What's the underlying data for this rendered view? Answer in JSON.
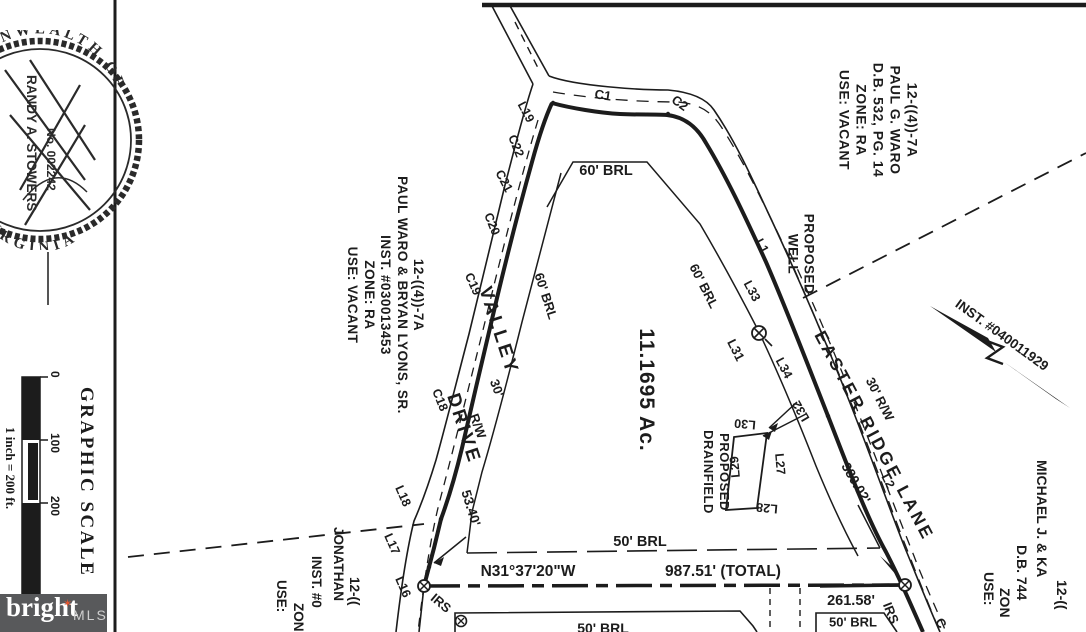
{
  "page": {
    "ink": "#1c1c1c",
    "paper": "#ffffff"
  },
  "seal": {
    "arc_top": "COMMONWEALTH OF",
    "arc_bottom": "VIRGINIA",
    "name": "RANDY A. STOWERS",
    "number": "No. 002242"
  },
  "scalebar": {
    "title": "GRAPHIC SCALE",
    "ticks": {
      "t0": "0",
      "t1": "100",
      "t2": "200"
    },
    "caption": "1 inch = 200 ft."
  },
  "watermark": {
    "brand": "bright",
    "suffix": "MLS",
    "star": "✶",
    "star_color": "#e8542d",
    "bg": "#58595b"
  },
  "subject": {
    "area": "11.1695 Ac."
  },
  "parcels": {
    "west": {
      "id": "12-((4))-7A",
      "owner": "PAUL WARO & BRYAN LYONS, SR.",
      "ref": "INST. #030013453",
      "zone": "ZONE: RA",
      "use": "USE: VACANT"
    },
    "north": {
      "id": "12-((4))-7A",
      "owner": "PAUL G. WARO",
      "ref": "D.B. 532, PG. 14",
      "zone": "ZONE: RA",
      "use": "USE: VACANT"
    },
    "east": {
      "id": "12-((",
      "owner": "MICHAEL J. & KA",
      "ref": "D.B. 744",
      "zone": "ZON",
      "use": "USE:"
    },
    "south": {
      "id": "12-((",
      "owner": "JONATHAN",
      "ref": "INST. #0",
      "zone": "ZON",
      "use": "USE:"
    }
  },
  "roads": {
    "valley": {
      "name1": "VALLEY",
      "name2": "DRIVE",
      "rw1": "30'",
      "rw2": "R/W"
    },
    "easter": {
      "name": "EASTER RIDGE LANE",
      "rw": "30' R/W",
      "dist": "380.02'"
    }
  },
  "boundary": {
    "bearing": "N31°37'20\"W",
    "distance": "987.51' (TOTAL)",
    "segment": "261.58'",
    "tie": "53.40'"
  },
  "brl": {
    "top": "60' BRL",
    "west": "60' BRL",
    "east": "60' BRL",
    "south": "50' BRL",
    "lower_box": "50' BRL",
    "lower": "50' BRL"
  },
  "features": {
    "well1": "PROPOSED",
    "well2": "WELL",
    "drain1": "PROPOSED",
    "drain2": "DRAINFIELD",
    "tie_note": "INST. #040011929"
  },
  "markers": {
    "irs_sw": "IRS",
    "irs_se": "IRS",
    "curve_partial": "C"
  },
  "segments": {
    "c1": "C1",
    "c2": "C2",
    "l1": "L1",
    "l2": "L2",
    "l16": "L16",
    "l17": "L17",
    "l18": "L18",
    "l19": "L19",
    "c18": "C18",
    "c19": "C19",
    "c20": "C20",
    "c21": "C21",
    "c22": "C22",
    "l27": "L27",
    "l28": "L28",
    "l29": "L29",
    "l30": "L30",
    "l31": "L31",
    "l32": "L32",
    "l33": "L33",
    "l34": "L34"
  }
}
